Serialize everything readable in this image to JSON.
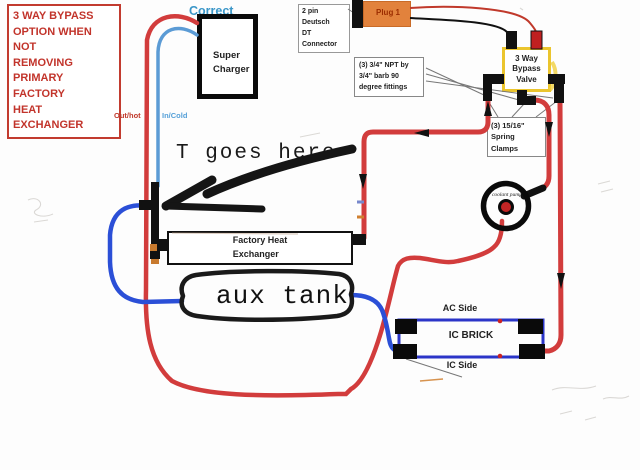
{
  "diagram": {
    "warning_note": "3 WAY BYPASS\nOPTION WHEN NOT\nREMOVING\nPRIMARY FACTORY\nHEAT EXCHANGER",
    "correct_label": "Correct",
    "supercharger_label": "Super\nCharger",
    "deutsch_connector_label": "2 pin Deutsch\nDT Connector",
    "plug_label": "Plug 1",
    "bypass_valve_label": "3 Way\nBypass\nValve",
    "npt_fittings_label": "(3) 3/4\" NPT by\n3/4\" barb 90\ndegree fittings",
    "spring_clamps_label": "(3) 15/16\"\nSpring Clamps",
    "out_hot_label": "Out/hot",
    "in_cold_label": "In/Cold",
    "t_goes_here_label": "T goes here",
    "factory_heat_exchanger_label": "Factory Heat\nExchanger",
    "aux_tank_label": "aux tank",
    "coolant_pump_label": "coolant pump",
    "ac_side_label": "AC Side",
    "ic_brick_label": "IC BRICK",
    "ic_side_label": "IC Side"
  },
  "colors": {
    "hot_hose_red": "#D23C3C",
    "cold_hose_blue": "#2B4FD7",
    "supercharger_in_blue": "#5B9BD5",
    "warning_red": "#C2342B",
    "correct_teal": "#3A96C8",
    "valve_yellow": "#EBC52E",
    "plug_orange": "#E2823C",
    "intercooler_brick_blue": "#2B35C8",
    "fitting_black": "#111111",
    "clamp_orange": "#C87A2E"
  }
}
